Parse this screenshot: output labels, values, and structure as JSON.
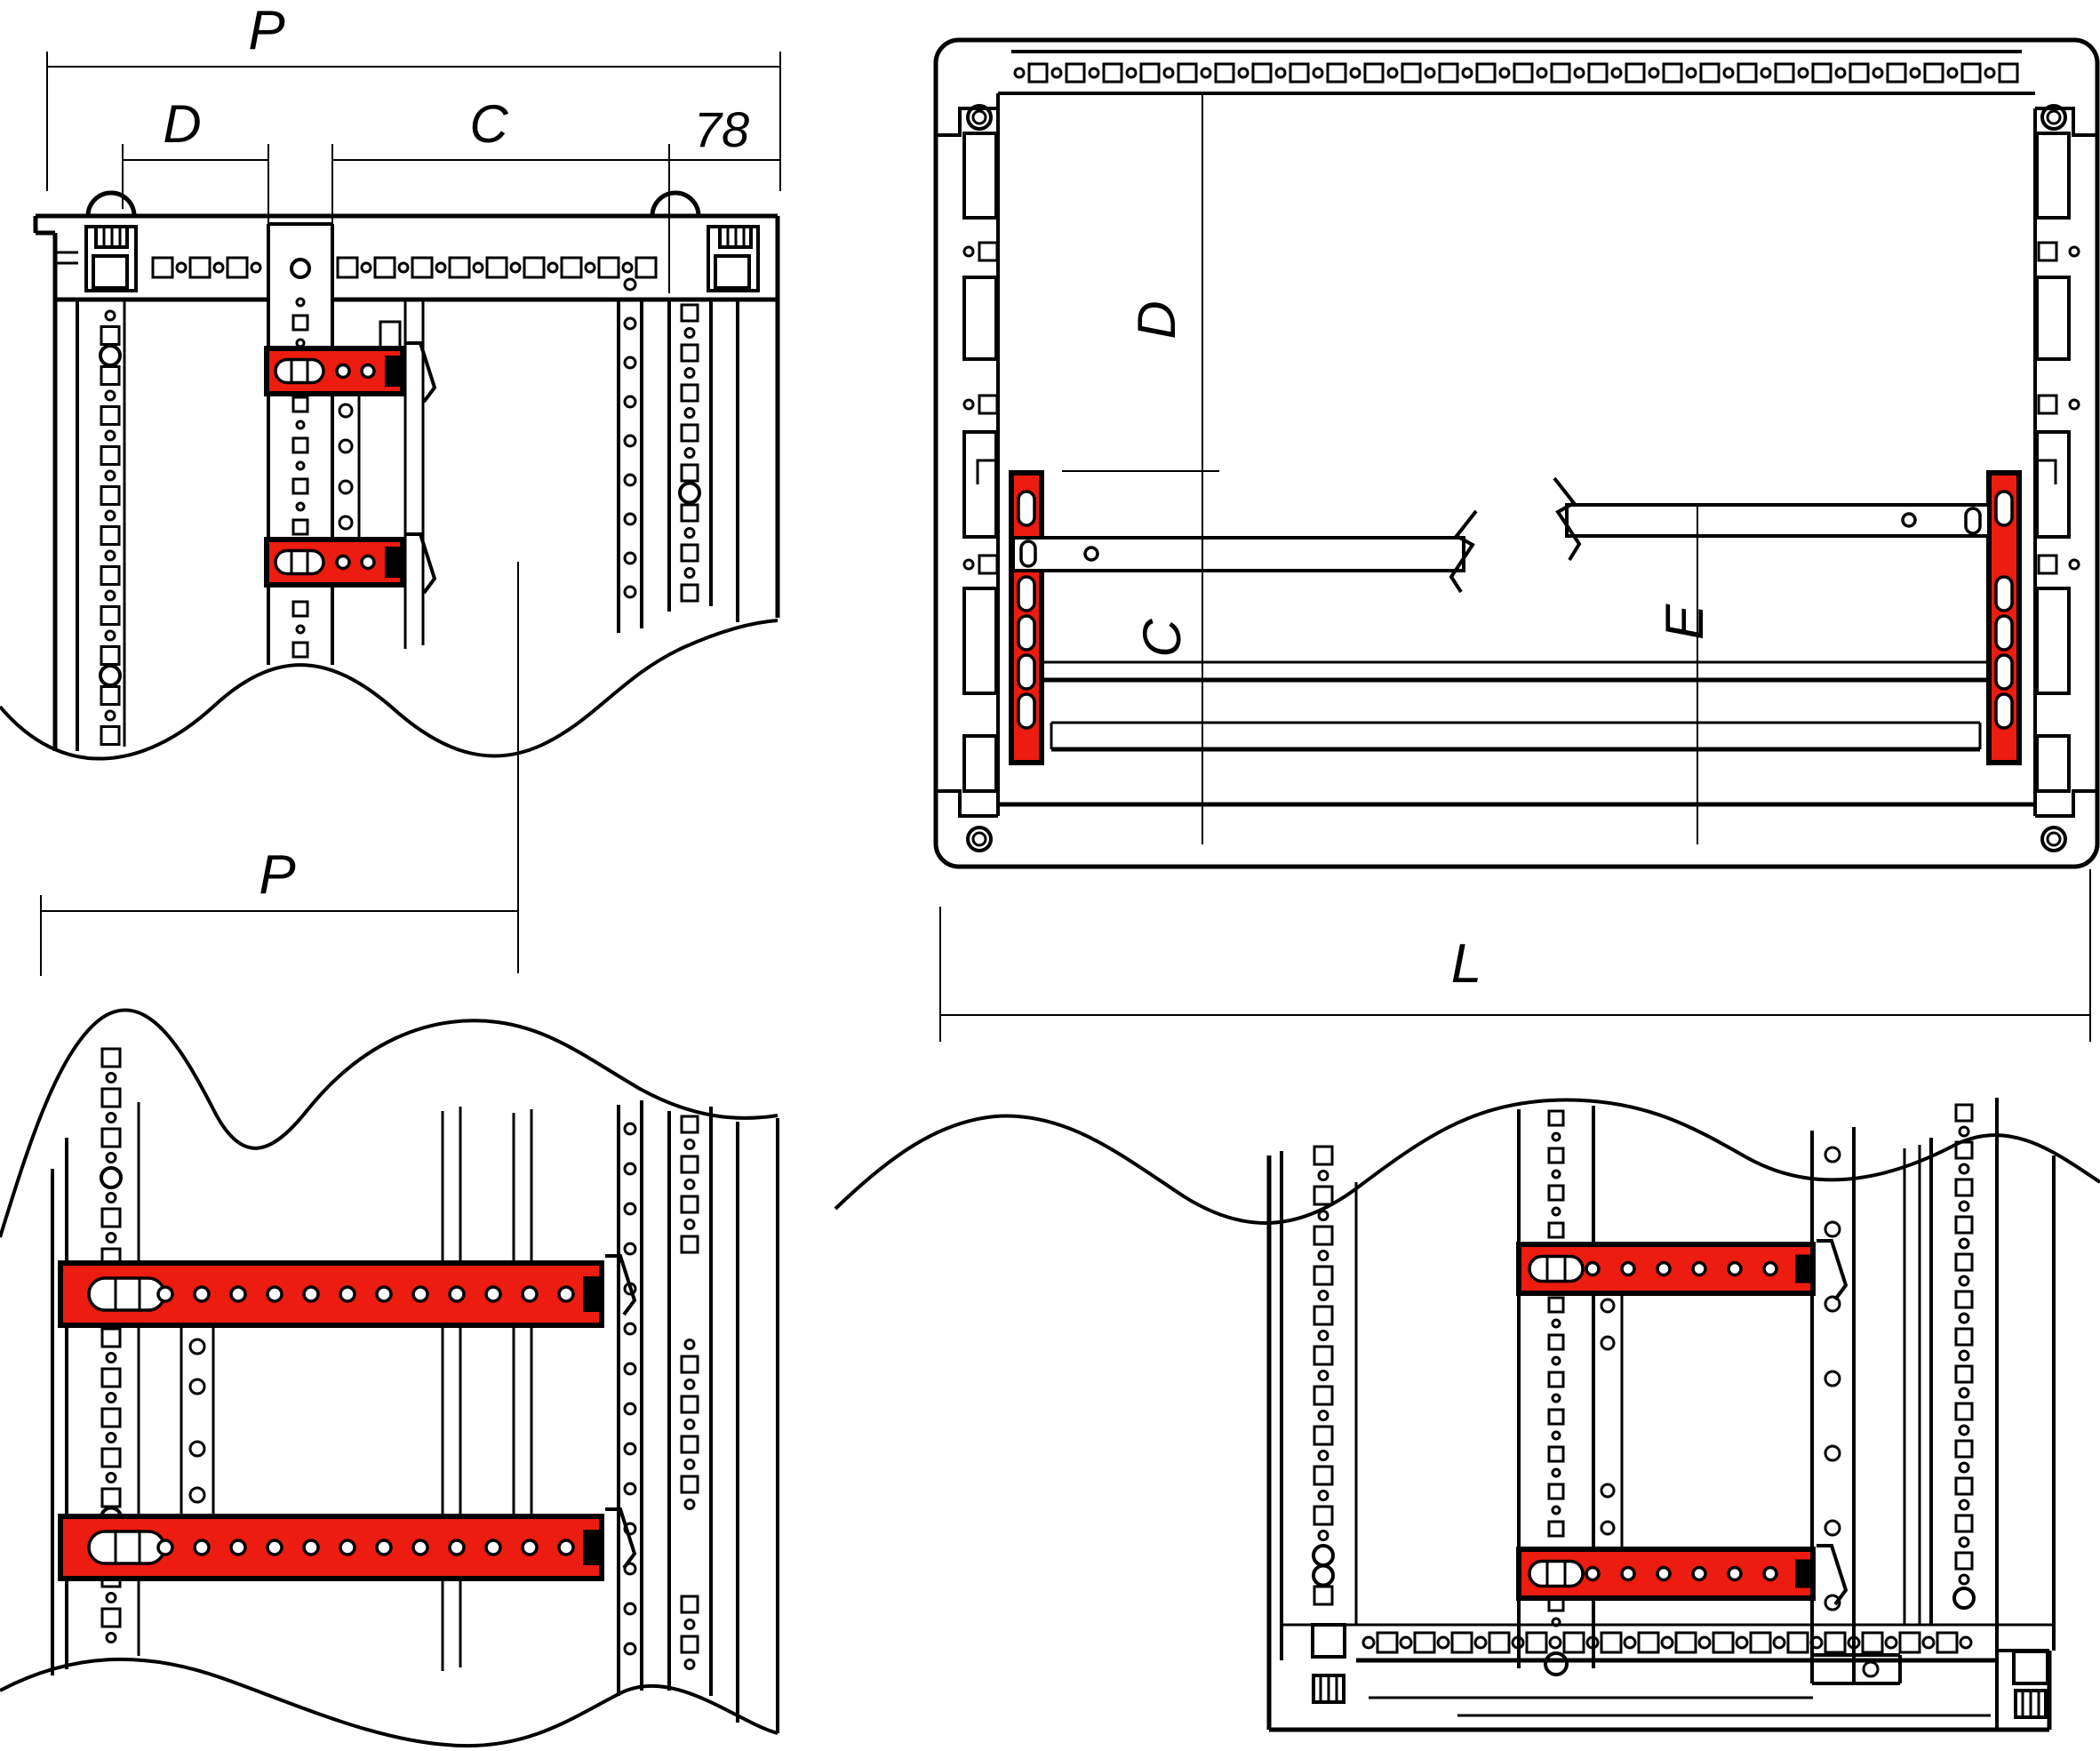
{
  "colors": {
    "accent_red": "#ed1c10",
    "line": "#000000",
    "background": "#ffffff"
  },
  "views": {
    "top_left": {
      "labels": {
        "p": "P",
        "d": "D",
        "c": "C",
        "offset": "78"
      }
    },
    "top_right": {
      "labels": {
        "d": "D",
        "c": "C",
        "e": "E",
        "l": "L"
      }
    },
    "bottom_left": {
      "labels": {
        "p": "P"
      }
    },
    "bottom_right": {
      "labels": {}
    }
  }
}
